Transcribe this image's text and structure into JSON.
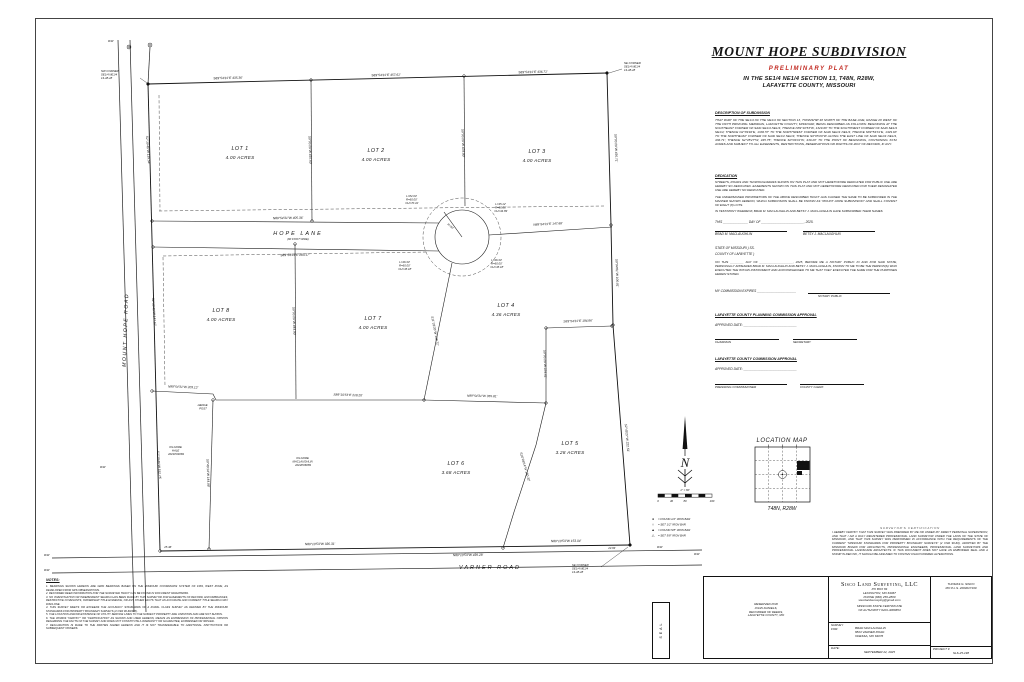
{
  "header": {
    "title": "MOUNT HOPE SUBDIVISION",
    "subtitle": "PRELIMINARY PLAT",
    "location1": "IN THE SE1/4 NE1/4 SECTION 13, T48N, R28W,",
    "location2": "LAFAYETTE COUNTY, MISSOURI"
  },
  "description": {
    "heading": "DESCRIPTION OF SUBDIVISION",
    "body": "THAT PART OF THE SE1/4 OF THE NE1/4 OF SECTION 13, TOWNSHIP 48 NORTH OF THE BASE LINE, RANGE 28 WEST OF THE FIFTH PRINCIPAL MERIDIAN, LAFAYETTE COUNTY, MISSOURI, BEING DESCRIBED AS FOLLOWS: BEGINNING AT THE SOUTHEAST CORNER OF SAID SE1/4 NE1/4; THENCE N89°10'53\"W, 1329.68' TO THE SOUTHWEST CORNER OF SAID SE1/4 NE1/4; THENCE N2°39'46\"E, 1336.57' TO THE NORTHWEST CORNER OF SAID SE1/4 NE1/4; THENCE S89°54'31\"E, 1329.63' TO THE NORTHEAST CORNER OF SAID SE1/4 NE1/4; THENCE S0°05'29\"W ALONG THE EAST LINE OF SAID SE1/4 NE1/4, 436.71'; THENCE S2°45'27\"W, 445.75'; THENCE S0°04'01\"W, 439.28' TO THE POINT OF BEGINNING, CONTAINING 33.52 ACRES AND SUBJECT TO ALL EASEMENTS, RESTRICTIONS, RESERVATIONS OR RIGHTS-OF-WAY OF RECORD, IF ANY."
  },
  "dedication": {
    "heading": "DEDICATION",
    "para1": "STREETS, ROADS AND THOROUGHFARES SHOWN ON THIS PLAT AND NOT HERETOFORE DEDICATED FOR PUBLIC USE ARE HEREBY SO DEDICATED. EASEMENTS SHOWN ON THIS PLAT AND NOT HERETOFORE DEDICATED FOR THEIR DESIGNATED USE ARE HEREBY SO DEDICATED.",
    "para2": "THE UNDERSIGNED PROPRIETORS OF THE ABOVE DESCRIBED TRACT HAS CAUSED THE SAME TO BE SUBDIVIDED IN THE MANNER SHOWN HEREON, WHICH SUBDIVISION SHALL BE KNOWN AS \"MOUNT HOPE SUBDIVISION\" AND SHALL CONSIST OF EIGHT (8) LOTS.",
    "testimony": "IN TESTIMONY WHEREOF, BRAD M. MACLAUGHLIN AND BETSY J. MACLAUGHLIN HAVE SUBSCRIBED THEIR NAMES",
    "date_line": "THIS ______________ DAY OF ________________________, 2025."
  },
  "signatures": {
    "owner1": "BRAD M. MACLAUGHLIN",
    "owner2": "BETSY J. MACLAUGHLIN"
  },
  "notary": {
    "state": "STATE OF MISSOURI      )",
    "ss": "  SS.",
    "county": "COUNTY OF LAFAYETTE  )",
    "body": "ON THIS ________ DAY OF ____________________, 2025, BEFORE ME A NOTARY PUBLIC IN AND FOR SAID STATE, PERSONALLY APPEARED BRAD M. MACLAUGHLIN AND BETSY J. MACLAUGHLIN, KNOWN TO ME TO BE THE PERSON(S) WHO EXECUTED THE WITHIN INSTRUMENT AND ACKNOWLEDGED TO ME THAT THEY EXECUTED THE SAME FOR THE PURPOSES HEREIN STATED.",
    "expires": "MY COMMISSION EXPIRES ______________________",
    "public": "NOTARY PUBLIC"
  },
  "planning": {
    "heading": "LAFAYETTE COUNTY PLANNING COMMISSION APPROVAL",
    "approved": "APPROVED DATE:  ______________________________",
    "left": "CHAIRMAN",
    "right": "SECRETARY"
  },
  "county_commission": {
    "heading": "LAFAYETTE COUNTY COMMISSION APPROVAL",
    "approved": "APPROVED DATE:  ______________________________",
    "left": "PRESIDING COMMISSIONER",
    "right": "COUNTY CLERK"
  },
  "compass": {
    "n": "N"
  },
  "scale": {
    "ratio": "1\" = 80'",
    "t0": "0",
    "t1": "40",
    "t2": "80",
    "t3": "160"
  },
  "legend": {
    "i0s": "●",
    "i0": "= FOUND 1/2\" IRON BAR",
    "i1s": "○",
    "i1": "= SET 1/2\" IRON BAR",
    "i2s": "▲",
    "i2": "= FOUND 5/8\" IRON BAR",
    "i3s": "△",
    "i3": "= SET 5/8\" IRON BAR"
  },
  "location_map": {
    "title": "LOCATION MAP",
    "township": "T48N, R28W",
    "site": "SITE"
  },
  "certification": {
    "heading": "SURVEYOR'S CERTIFICATION",
    "body": "I HEREBY CERTIFY THAT THIS SURVEY WAS PREPARED BY ME OR UNDER MY DIRECT PERSONAL SUPERVISION, AND THAT I AM A DULY REGISTERED PROFESSIONAL LAND SURVEYOR UNDER THE LAWS OF THE STATE OF MISSOURI, AND THAT THIS SURVEY WAS PERFORMED IN ACCORDANCE WITH THE REQUIREMENTS OF THE CURRENT \"MISSOURI STANDARDS FOR PROPERTY BOUNDARY SURVEYS\" (2 CSR 90-60), ADOPTED BY THE MISSOURI BOARD FOR ARCHITECTS, PROFESSIONAL ENGINEERS, PROFESSIONAL LAND SURVEYORS AND PROFESSIONAL LANDSCAPE ARCHITECTS. IF THIS DOCUMENT DOES NOT HAVE AN EMBOSSED SEAL AND A STAMP IN RED INK, IT SHOULD BE ASSUMED TO CONTAIN UNAUTHORIZED ALTERATIONS."
  },
  "title_block": {
    "seal": "SEAL",
    "reserved1": "RESERVED FOR",
    "reserved2": "JOHN DANIELS,",
    "reserved3": "RECORDER OF DEEDS,",
    "reserved4": "LAFAYETTE COUNTY, MO",
    "company": "Sisco Land Surveying, LLC",
    "addr1": "PO BOX 84",
    "addr2": "LEXINGTON, MO 64067",
    "addr3": "PHONE (660) 259-2800",
    "addr4": "siscolandsurveying@gmail.com",
    "cert1": "MISSOURI STATE CERTIFICATE",
    "cert2": "OF AUTHORITY #201-3006653",
    "surveyor1": "THOMAS G. SISCO",
    "surveyor2": "MO P.L.S. 2003017190",
    "sf1": "SURVEY",
    "sf2": "FOR:",
    "client1": "BRAD MACLAUGHLIN",
    "client2": "8823 VARNER ROAD",
    "client3": "ODESSA, MO 64076",
    "date_label": "DATE:",
    "date": "SEPTEMBER 22, 2025",
    "project_label": "PROJECT #",
    "project": "SLS-25-198"
  },
  "notes": {
    "heading": "NOTES:",
    "items": [
      "1. BEARINGS SHOWN HEREON ARE GRID BEARINGS BASED ON THE MISSOURI COORDINATE SYSTEM OF 1983, WEST ZONE, AS DEVELOPED FROM GPS OBSERVATIONS.",
      "2. RECORDED DEED INFORMATION FOR THE SURVEYED TRACT CAN BE FOUND IN DOCUMENT #2022P04069.",
      "3. NO INVESTIGATION OR INDEPENDENT SEARCH HAS BEEN MADE BY THIS SURVEYOR FOR EASEMENTS OF RECORD, ENCUMBRANCES, RESTRICTIVE COVENANTS, OWNERSHIP TITLE EVIDENCE, OR ANY OTHER FACTS THAT AN ACCURATE AND CURRENT TITLE SEARCH MAY DISCLOSE.",
      "4. THIS SURVEY MEETS OR EXCEEDS THE ACCURACY STANDARDS OF A RURAL CLASS SURVEY AS DEFINED BY THE MISSOURI STANDARDS FOR PROPERTY BOUNDARY SURVEYS (2 CSR 90-60/465).",
      "5. THE LOCATION AND/OR EXISTENCE OF UTILITY SERVICE LINES TO THE SUBJECT PROPERTY ARE UNKNOWN AND ARE NOT SHOWN.",
      "6. THE WORDS \"CERTIFY\" OR \"CERTIFICATION\" AS SHOWN AND USED HEREON, MEANS AN EXPRESSION OF PROFESSIONAL OPINION REGARDING THE FACTS OF THE SURVEY AND DOES NOT CONSTITUTE A WARRANTY OR GUARANTEE, EXPRESSED OR IMPLIED.",
      "7. DECLARATION IS MADE TO THE PARTIES NAMED HEREON AND IT IS NOT TRANSFERABLE TO ADDITIONAL INSTITUTIONS OR SUBSEQUENT OWNERS."
    ]
  },
  "plat": {
    "roads": {
      "mount_hope": "MOUNT  HOPE  ROAD",
      "varner": "VARNER   ROAD",
      "hope_lane": "HOPE   LANE",
      "hope_lane_width": "(60 FOOT WIDE)"
    },
    "lots": [
      {
        "name": "LOT 1",
        "acres": "4.00 ACRES"
      },
      {
        "name": "LOT 2",
        "acres": "4.00 ACRES"
      },
      {
        "name": "LOT 3",
        "acres": "4.00 ACRES"
      },
      {
        "name": "LOT 4",
        "acres": "4.36 ACRES"
      },
      {
        "name": "LOT 5",
        "acres": "3.28 ACRES"
      },
      {
        "name": "LOT 6",
        "acres": "3.68 ACRES"
      },
      {
        "name": "LOT 7",
        "acres": "4.00 ACRES"
      },
      {
        "name": "LOT 8",
        "acres": "4.00 ACRES"
      }
    ],
    "bearings": [
      "S89°54'31\"E 435.36'",
      "S89°54'31\"E 457.61'",
      "S89°54'31\"E 436.71'",
      "S2°39'46\"W 139.54'",
      "S2°39'46\"W 147.67'",
      "S2°39'46\"W 152.75'",
      "S0°05'29\"W 436.71'",
      "S0°04'01\"W 100.01'",
      "S2°45'27\"W 222.51'",
      "N89°54'31\"W 405.36'",
      "S89°54'31\"E 283.17'",
      "N89°54'31\"E 147.68'",
      "S0°05'29\"W 435.60'",
      "S0°05'29\"W 428.80'",
      "S0°05'29\"W 444.90'",
      "S11°26'35\"W 138.72'",
      "S0°05'29\"W 224.61'",
      "S89°54'31\"E 194.86'",
      "N89°54'31\"W 355.81'",
      "N89°54'31\"W 203.12'",
      "S89°10'53\"E 218.20'",
      "S16°08'14\"W 150.32'",
      "S0°49'14\"W 144.08'",
      "N89°10'53\"W 336.31'",
      "N89°10'53\"W 153.04'",
      "N89°10'53\"W 439.28'",
      "25.46'",
      "23.84'"
    ],
    "curves": [
      {
        "a": "L=82.03'",
        "b": "R=60.00'",
        "c": "CH=70.41'"
      },
      {
        "a": "L=35.12'",
        "b": "R=60.00'",
        "c": "CH=34.89'"
      },
      {
        "a": "L=46.33'",
        "b": "R=60.00'",
        "c": "CH=45.18'"
      },
      {
        "a": "L=46.33'",
        "b": "R=60.00'",
        "c": "CH=45.18'"
      }
    ],
    "radius_label": "R=50'",
    "corners": [
      {
        "l1": "NW CORNER",
        "l2": "SE1/4 NE1/4",
        "l3": "13-48-28"
      },
      {
        "l1": "NE CORNER",
        "l2": "SE1/4 NE1/4",
        "l3": "13-48-28"
      },
      {
        "l1": "SE CORNER",
        "l2": "SE1/4 NE1/4",
        "l3": "13-48-28"
      }
    ],
    "rw": "R/W",
    "owners": [
      {
        "l1": "KILGORE",
        "l2": "HALE",
        "l3": "2021P04069"
      },
      {
        "l1": "KILGORE",
        "l2": "MACLAUGHLIN",
        "l3": "2022P06089"
      }
    ],
    "hedge1": "HEDGE",
    "hedge2": "POST"
  }
}
